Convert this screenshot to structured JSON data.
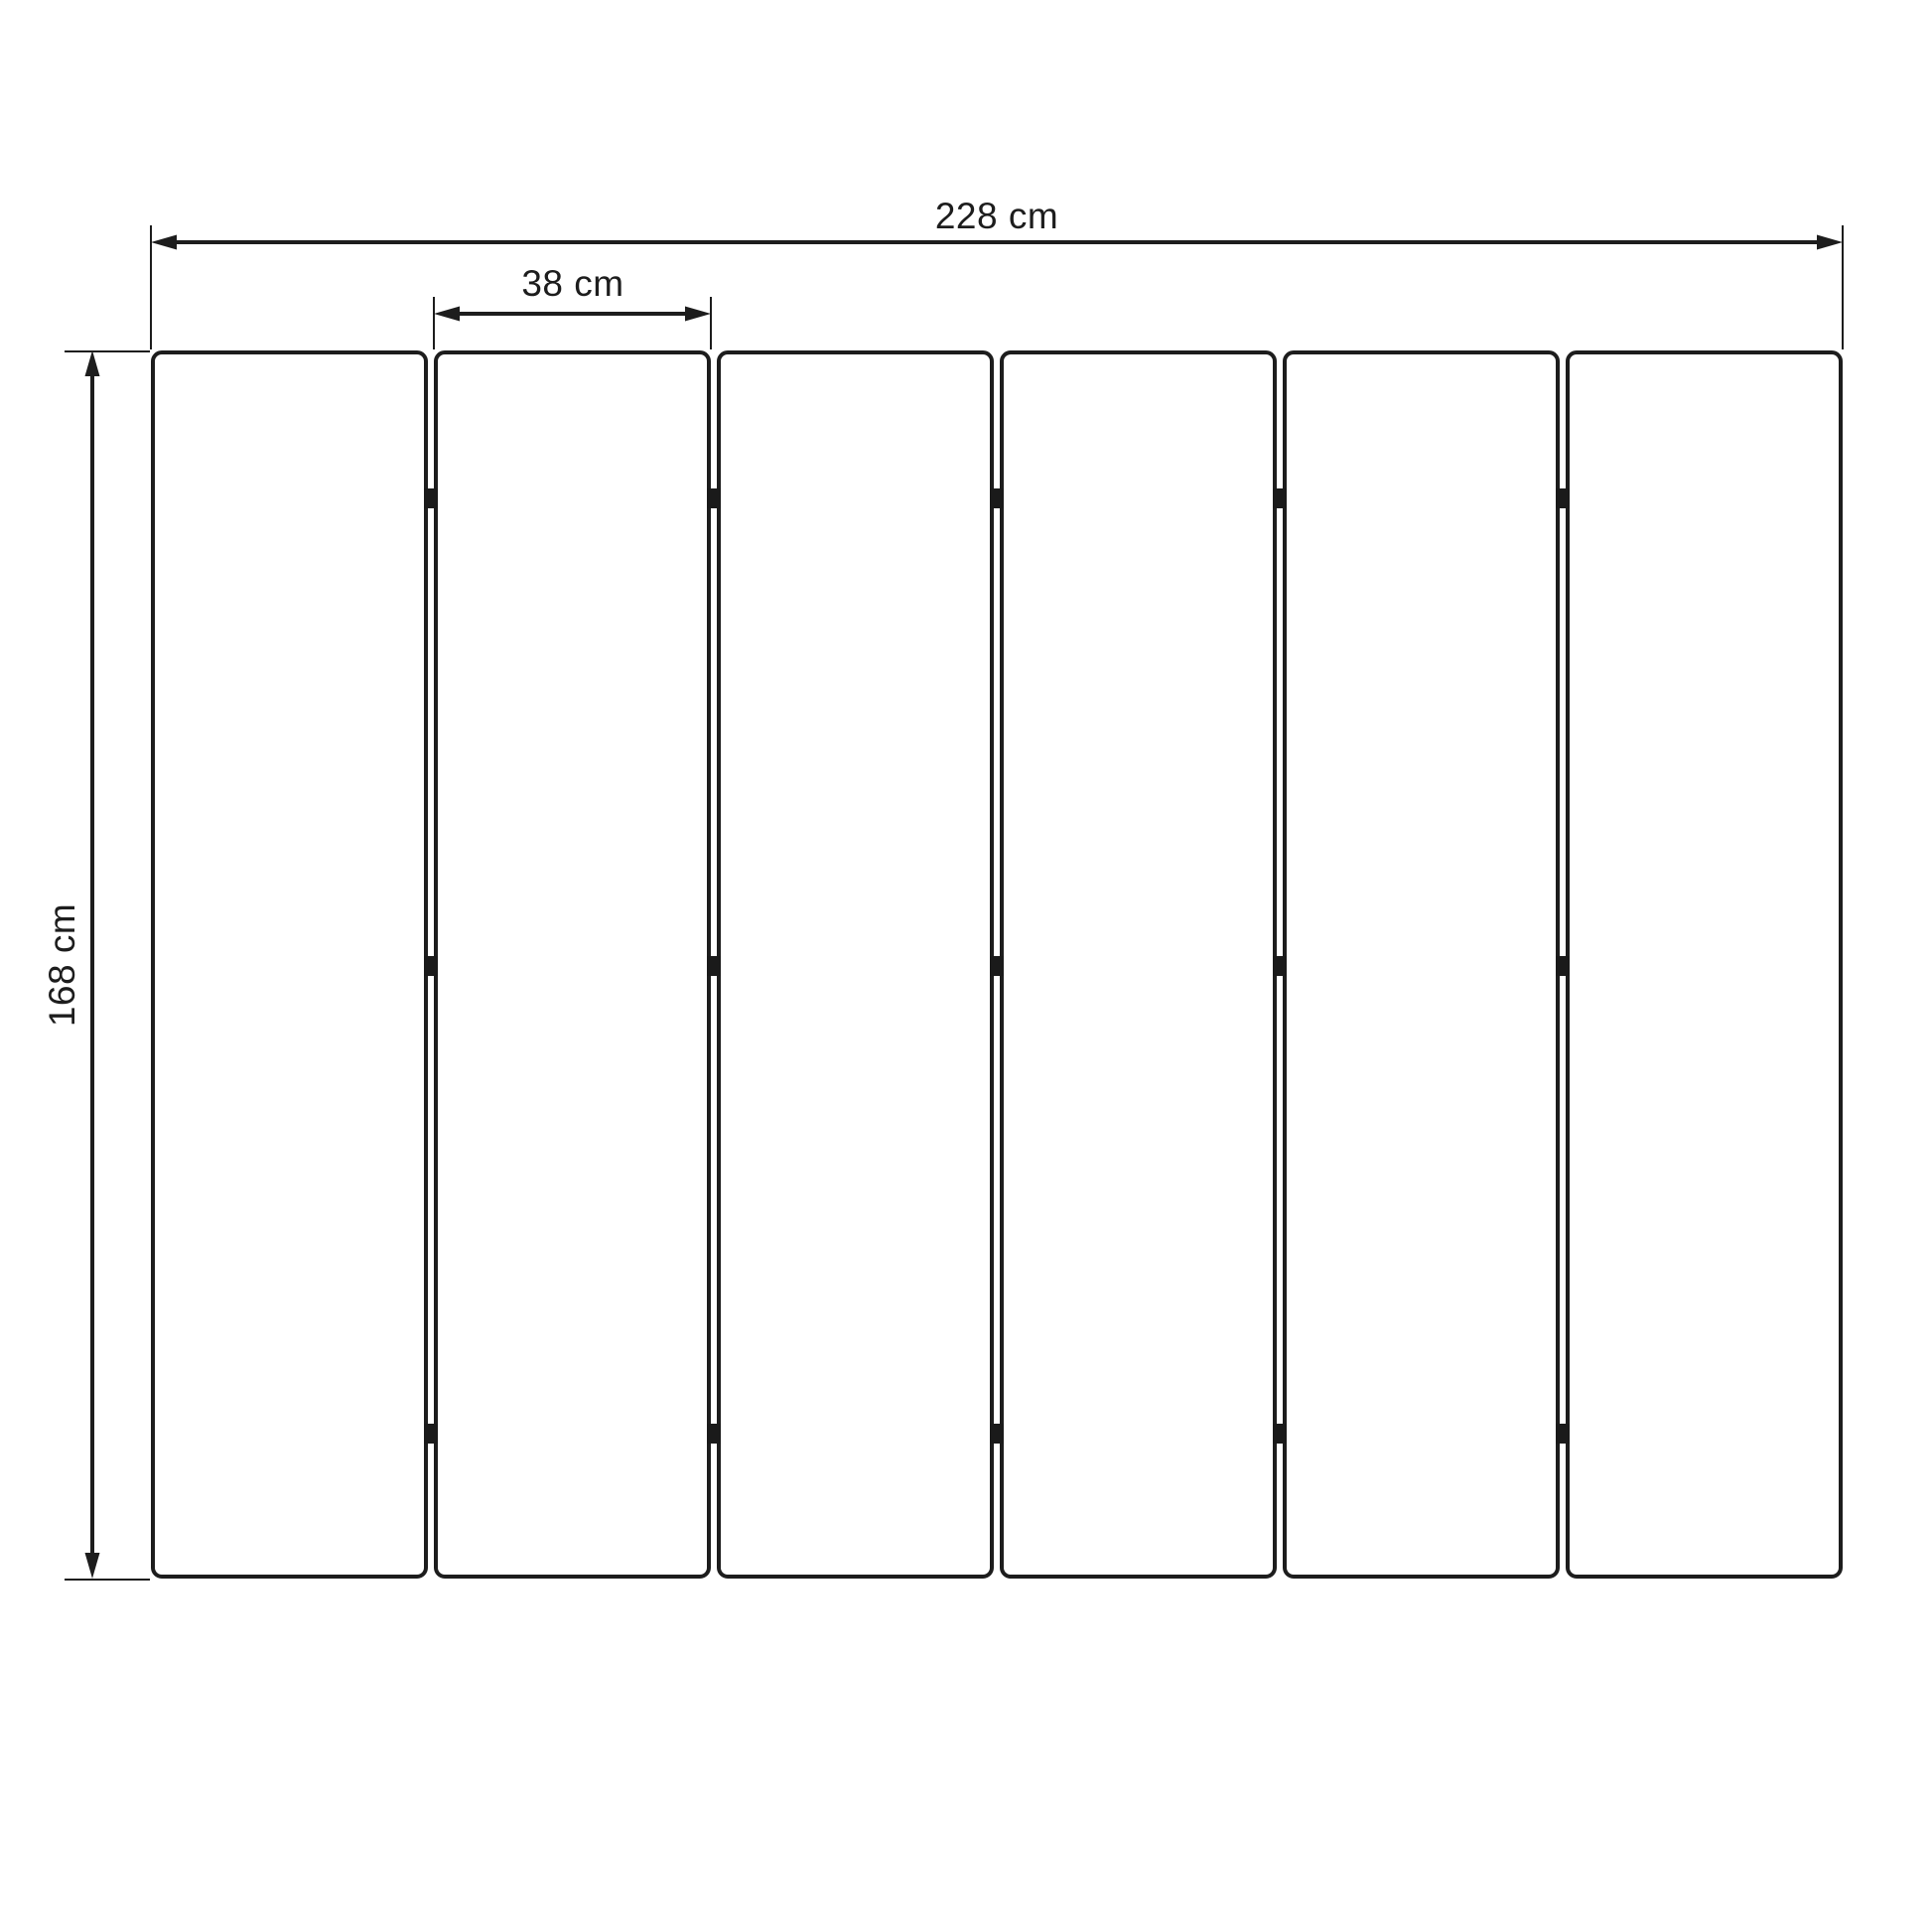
{
  "diagram": {
    "kind": "technical dimension drawing",
    "subject": "six vertical panels joined by hinges, front elevation",
    "background_color": "#ffffff",
    "line_color": "#1d1d1d",
    "hinge_color": "#1a1a1a",
    "panels": {
      "count": 6,
      "hinge_columns": 5,
      "hinge_rows": 3
    },
    "dimensions": {
      "total_width": {
        "label": "228 cm",
        "value": 228,
        "unit": "cm",
        "orientation": "horizontal"
      },
      "panel_width": {
        "label": "38 cm",
        "value": 38,
        "unit": "cm",
        "orientation": "horizontal"
      },
      "height": {
        "label": "168 cm",
        "value": 168,
        "unit": "cm",
        "orientation": "vertical"
      }
    }
  }
}
